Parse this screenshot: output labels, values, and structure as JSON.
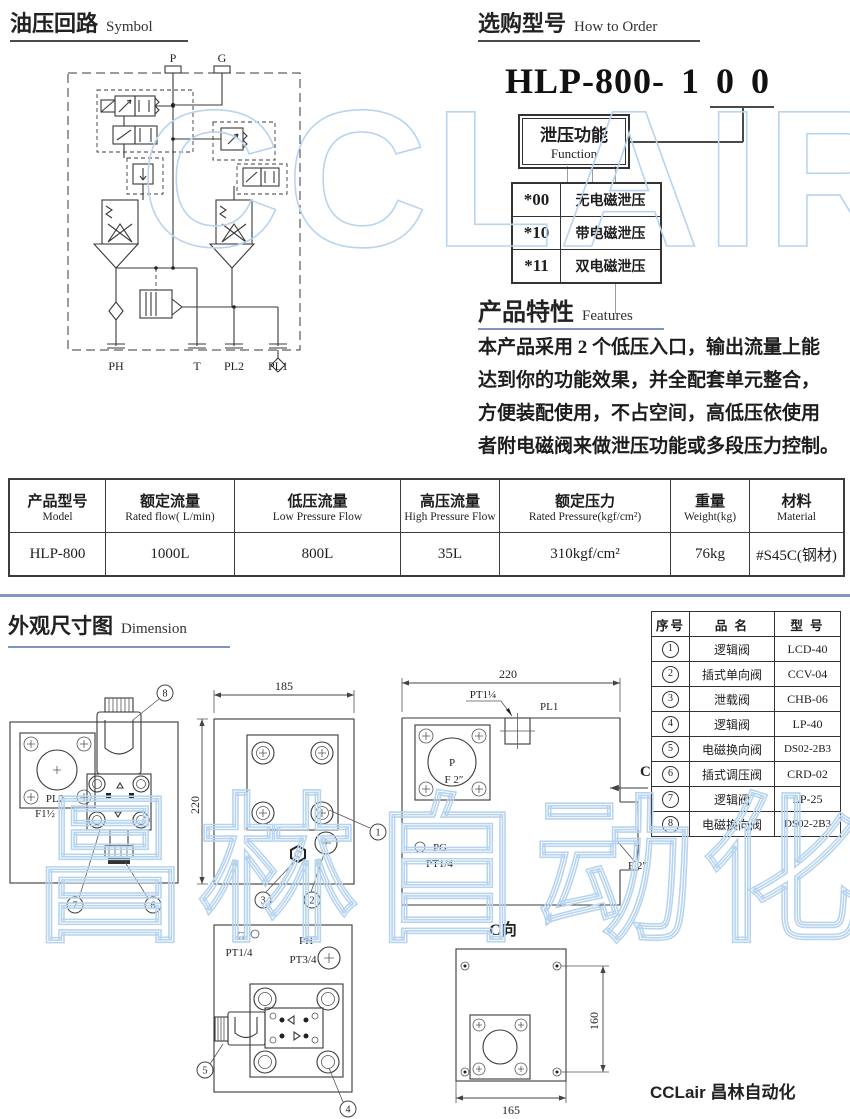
{
  "watermarks": {
    "top": "CCLAIR",
    "big": "昌林自动化",
    "color": "#b7d4ef"
  },
  "symbol": {
    "title_zh": "油压回路",
    "title_en": "Symbol",
    "ports_top": [
      "P",
      "G"
    ],
    "ports_bottom": [
      "PH",
      "T",
      "PL2",
      "PL1"
    ]
  },
  "order": {
    "title_zh": "选购型号",
    "title_en": "How to Order",
    "model_prefix": "HLP-800-",
    "digits": [
      "1",
      "0",
      "0"
    ],
    "function_zh": "泄压功能",
    "function_en": "Function",
    "options": [
      {
        "code": "*00",
        "label": "无电磁泄压"
      },
      {
        "code": "*10",
        "label": "带电磁泄压"
      },
      {
        "code": "*11",
        "label": "双电磁泄压"
      }
    ]
  },
  "features": {
    "title_zh": "产品特性",
    "title_en": "Features",
    "lines": [
      "本产品采用 2 个低压入口，输出流量上能",
      "达到你的功能效果，并全配套单元整合，",
      "方便装配使用，不占空间，高低压依使用",
      "者附电磁阀来做泄压功能或多段压力控制。"
    ]
  },
  "spec_table": {
    "headers": [
      {
        "zh": "产品型号",
        "en": "Model"
      },
      {
        "zh": "额定流量",
        "en": "Rated flow( L/min)"
      },
      {
        "zh": "低压流量",
        "en": "Low Pressure Flow"
      },
      {
        "zh": "高压流量",
        "en": "High Pressure Flow"
      },
      {
        "zh": "额定压力",
        "en": "Rated Pressure(kgf/cm²)"
      },
      {
        "zh": "重量",
        "en": "Weight(kg)"
      },
      {
        "zh": "材料",
        "en": "Material"
      }
    ],
    "row": [
      "HLP-800",
      "1000L",
      "800L",
      "35L",
      "310kgf/cm²",
      "76kg",
      "#S45C(钢材)"
    ]
  },
  "dimension": {
    "title_zh": "外观尺寸图",
    "title_en": "Dimension"
  },
  "parts_table": {
    "headers": [
      "序号",
      "品 名",
      "型 号"
    ],
    "rows": [
      {
        "no": "1",
        "name": "逻辑阀",
        "model": "LCD-40"
      },
      {
        "no": "2",
        "name": "插式单向阀",
        "model": "CCV-04"
      },
      {
        "no": "3",
        "name": "泄载阀",
        "model": "CHB-06"
      },
      {
        "no": "4",
        "name": "逻辑阀",
        "model": "LP-40"
      },
      {
        "no": "5",
        "name": "电磁换向阀",
        "model": "DS02-2B3"
      },
      {
        "no": "6",
        "name": "插式调压阀",
        "model": "CRD-02"
      },
      {
        "no": "7",
        "name": "逻辑阀",
        "model": "LP-25"
      },
      {
        "no": "8",
        "name": "电磁换向阀",
        "model": "DS02-2B3"
      }
    ]
  },
  "drawings": {
    "left": {
      "port": "PL2",
      "size": "F1½",
      "c8": "8",
      "c7": "7",
      "c6": "6"
    },
    "middle": {
      "dim_w": "185",
      "dim_h": "220",
      "c1": "1",
      "c3": "3",
      "c2": "2"
    },
    "right": {
      "dim_w": "220",
      "thread_top": "PT1¼",
      "port_top": "PL1",
      "port_p": "P",
      "size_p": "F 2″",
      "pg": "PG",
      "pg_thread": "PT1/4",
      "view": "C",
      "port_t": "T",
      "size_t": "F 2″"
    },
    "bottom_middle": {
      "g": "G",
      "g_thread": "PT1/4",
      "ph": "PH",
      "ph_thread": "PT3/4",
      "c5": "5",
      "c4": "4"
    },
    "bottom_right": {
      "view": "C向",
      "dim_h": "160",
      "dim_w": "165"
    }
  },
  "footer": {
    "brand": "CCLair 昌林自动化"
  }
}
